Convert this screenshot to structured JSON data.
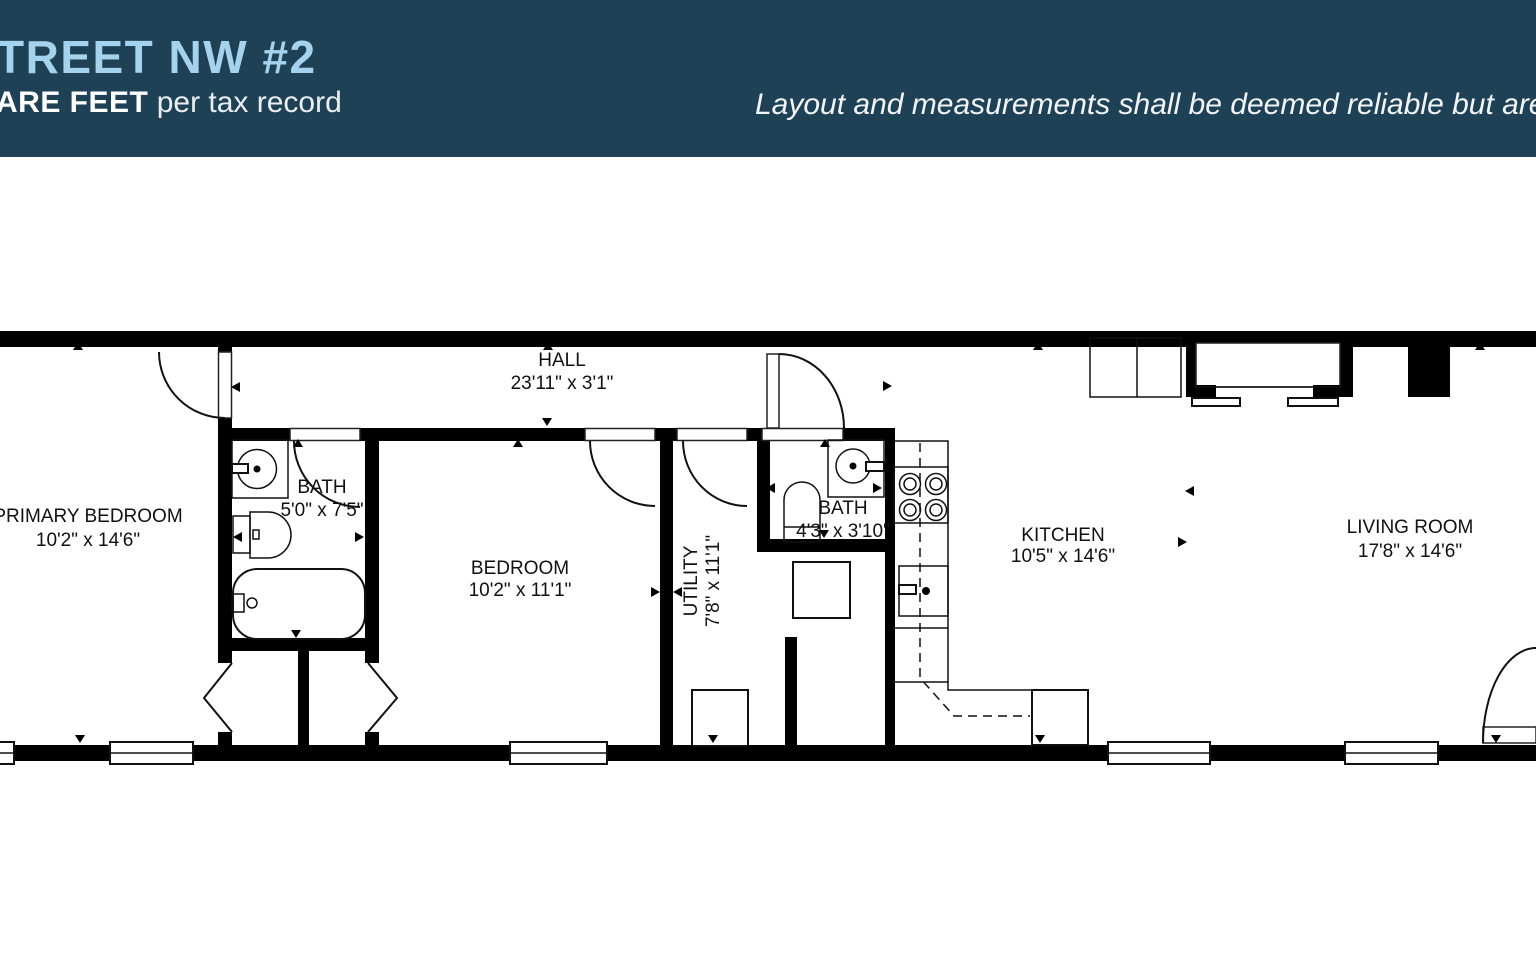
{
  "colors": {
    "header_bg": "#1f4156",
    "title_blue": "#a5d3ee",
    "header_text": "#ffffff",
    "plan_wall": "#000000",
    "plan_line": "#111111",
    "plan_bg": "#ffffff"
  },
  "header": {
    "title_visible": "TREET NW #2",
    "subtitle_bold": "ARE FEET",
    "subtitle_rest": " per tax record",
    "disclaimer_visible": "Layout and measurements shall be deemed reliable but are n"
  },
  "rooms": {
    "primary_bedroom": {
      "name": "PRIMARY BEDROOM",
      "dims": "10'2\" x 14'6\""
    },
    "primary_bath": {
      "name": "BATH",
      "dims": "5'0\" x 7'5\""
    },
    "bedroom": {
      "name": "BEDROOM",
      "dims": "10'2\" x 11'1\""
    },
    "hall": {
      "name": "HALL",
      "dims": "23'11\" x 3'1\""
    },
    "utility": {
      "name": "UTILITY",
      "dims": "7'8\" x 11'1\""
    },
    "bath_2": {
      "name": "BATH",
      "dims": "4'3\" x 3'10\""
    },
    "kitchen": {
      "name": "KITCHEN",
      "dims": "10'5\" x 14'6\""
    },
    "living_room": {
      "name": "LIVING ROOM",
      "dims": "17'8\" x 14'6\""
    }
  }
}
